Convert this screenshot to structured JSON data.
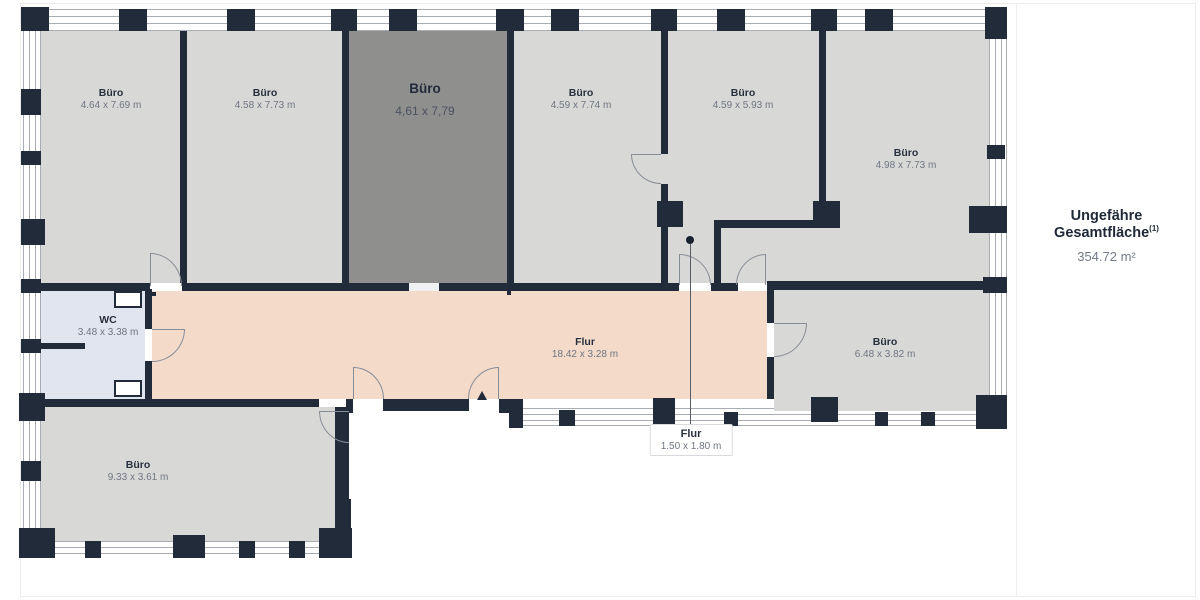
{
  "panel": {
    "title": "Ungefähre Gesamtfläche",
    "title_sup": "(1)",
    "area_value": "354.72 m²"
  },
  "plan": {
    "rooms": [
      {
        "name": "Büro",
        "dims": "4.64 x 7.69 m"
      },
      {
        "name": "Büro",
        "dims": "4.58 x 7.73 m"
      },
      {
        "name": "Büro",
        "dims": "4,61 x 7,79",
        "state": "selected"
      },
      {
        "name": "Büro",
        "dims": "4.59 x 7.74 m"
      },
      {
        "name": "Büro",
        "dims": "4.59 x 5.93 m"
      },
      {
        "name": "Büro",
        "dims": "4.98 x 7.73 m"
      },
      {
        "name": "WC",
        "dims": "3.48 x 3.38 m"
      },
      {
        "name": "Flur",
        "dims": "18.42 x 3.28 m"
      },
      {
        "name": "Büro",
        "dims": "6.48 x 3.82 m"
      },
      {
        "name": "Flur",
        "dims": "1.50 x 1.80 m"
      },
      {
        "name": "Büro",
        "dims": "9.33 x 3.61 m"
      }
    ],
    "colors": {
      "wall": "#212b3a",
      "room_fill": "#d8d8d6",
      "selected_room_fill": "#8f908e",
      "hallway_fill": "#f4dac9",
      "wc_fill": "#e1e5f0",
      "window_line": "#a8adb3"
    }
  }
}
